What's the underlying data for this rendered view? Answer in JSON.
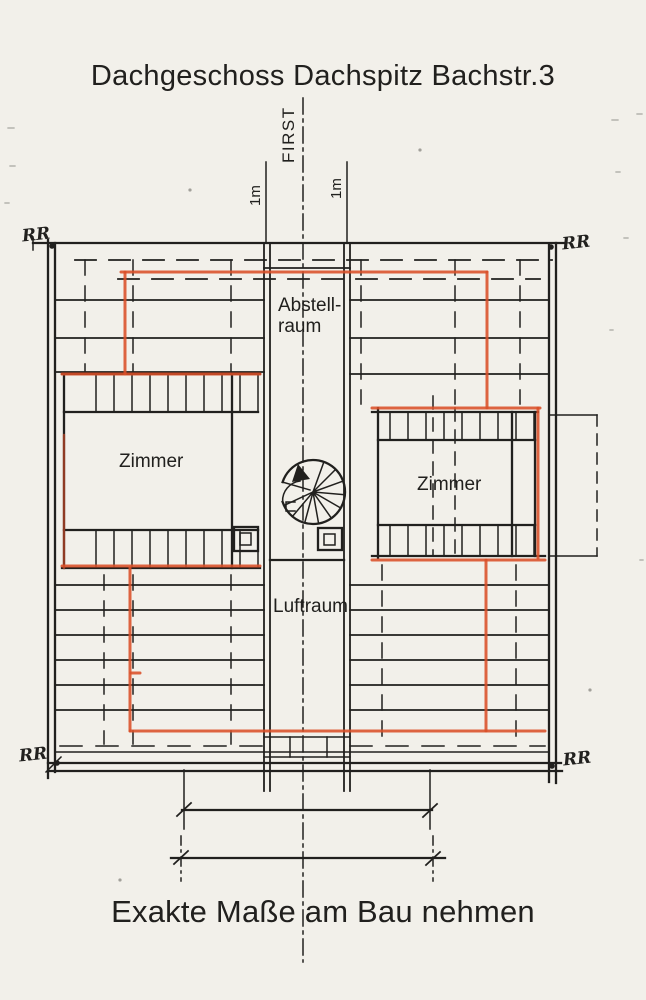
{
  "title": "Dachgeschoss Dachspitz Bachstr.3",
  "footer": "Exakte Maße am Bau nehmen",
  "plan": {
    "ridge_label": "FIRST",
    "dim_left_label": "1m",
    "dim_right_label": "1m",
    "storage_room_label_line1": "Abstell-",
    "storage_room_label_line2": "raum",
    "left_room_label": "Zimmer",
    "right_room_label": "Zimmer",
    "air_space_label": "Luftraum",
    "corner_labels": {
      "top_left": "RR",
      "top_right": "RR",
      "bottom_left": "RR",
      "bottom_right": "RR"
    }
  },
  "colors": {
    "ink": "#21201e",
    "highlight_red": "#d94e28",
    "paper": "#f2f0ea"
  }
}
